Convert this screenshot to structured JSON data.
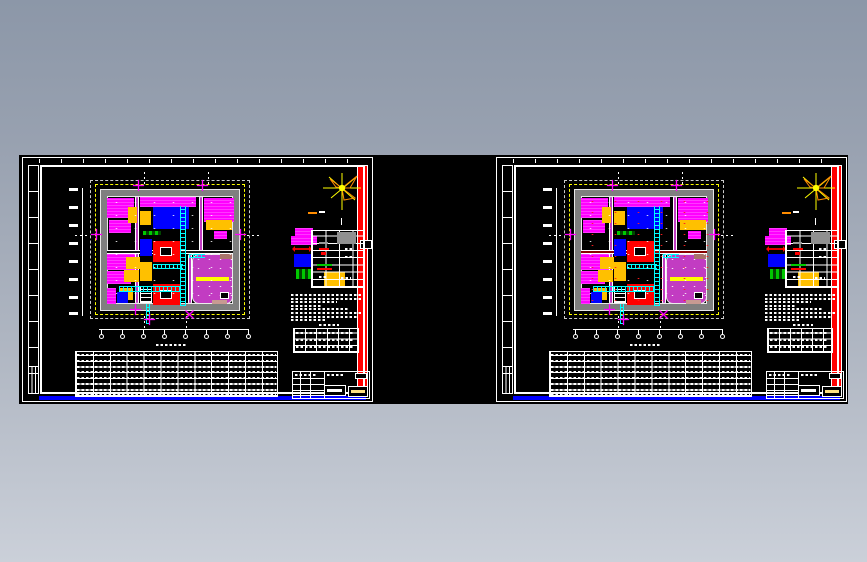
{
  "window": {
    "background_top": "#8c97a8",
    "background_bottom": "#cbd0d9",
    "canvas_color": "#000000",
    "description": "CAD drawing preview canvas showing two plan sheets side by side"
  },
  "sheets": [
    {
      "id": "sheet-1",
      "name": "floor-plan-sheet-left",
      "variant": "power-plan",
      "wall_accent": "#151515"
    },
    {
      "id": "sheet-2",
      "name": "floor-plan-sheet-right",
      "variant": "lighting-plan",
      "wall_accent": "#8b0000"
    }
  ],
  "palette": {
    "frame_white": "#ffffff",
    "building_wall_gray": "#7f7f7f",
    "site_boundary_yellow": "#ffff00",
    "equipment_magenta": "#ff00ff",
    "equipment_violet": "#c23cc2",
    "equipment_blue": "#0000ff",
    "equipment_red": "#ff0000",
    "equipment_orange": "#ffc000",
    "cable_tray_cyan": "#00ffff",
    "vegetation_green": "#00c800",
    "north_arrow_yellow": "#ffff00",
    "north_arrow_orange": "#ff8c00",
    "legend_gray_cell": "#909090",
    "accent_brown": "#a9746b",
    "partition_red_variant": "#8b0000"
  },
  "icons": {
    "north_arrow": "wind-rose-star-icon"
  }
}
